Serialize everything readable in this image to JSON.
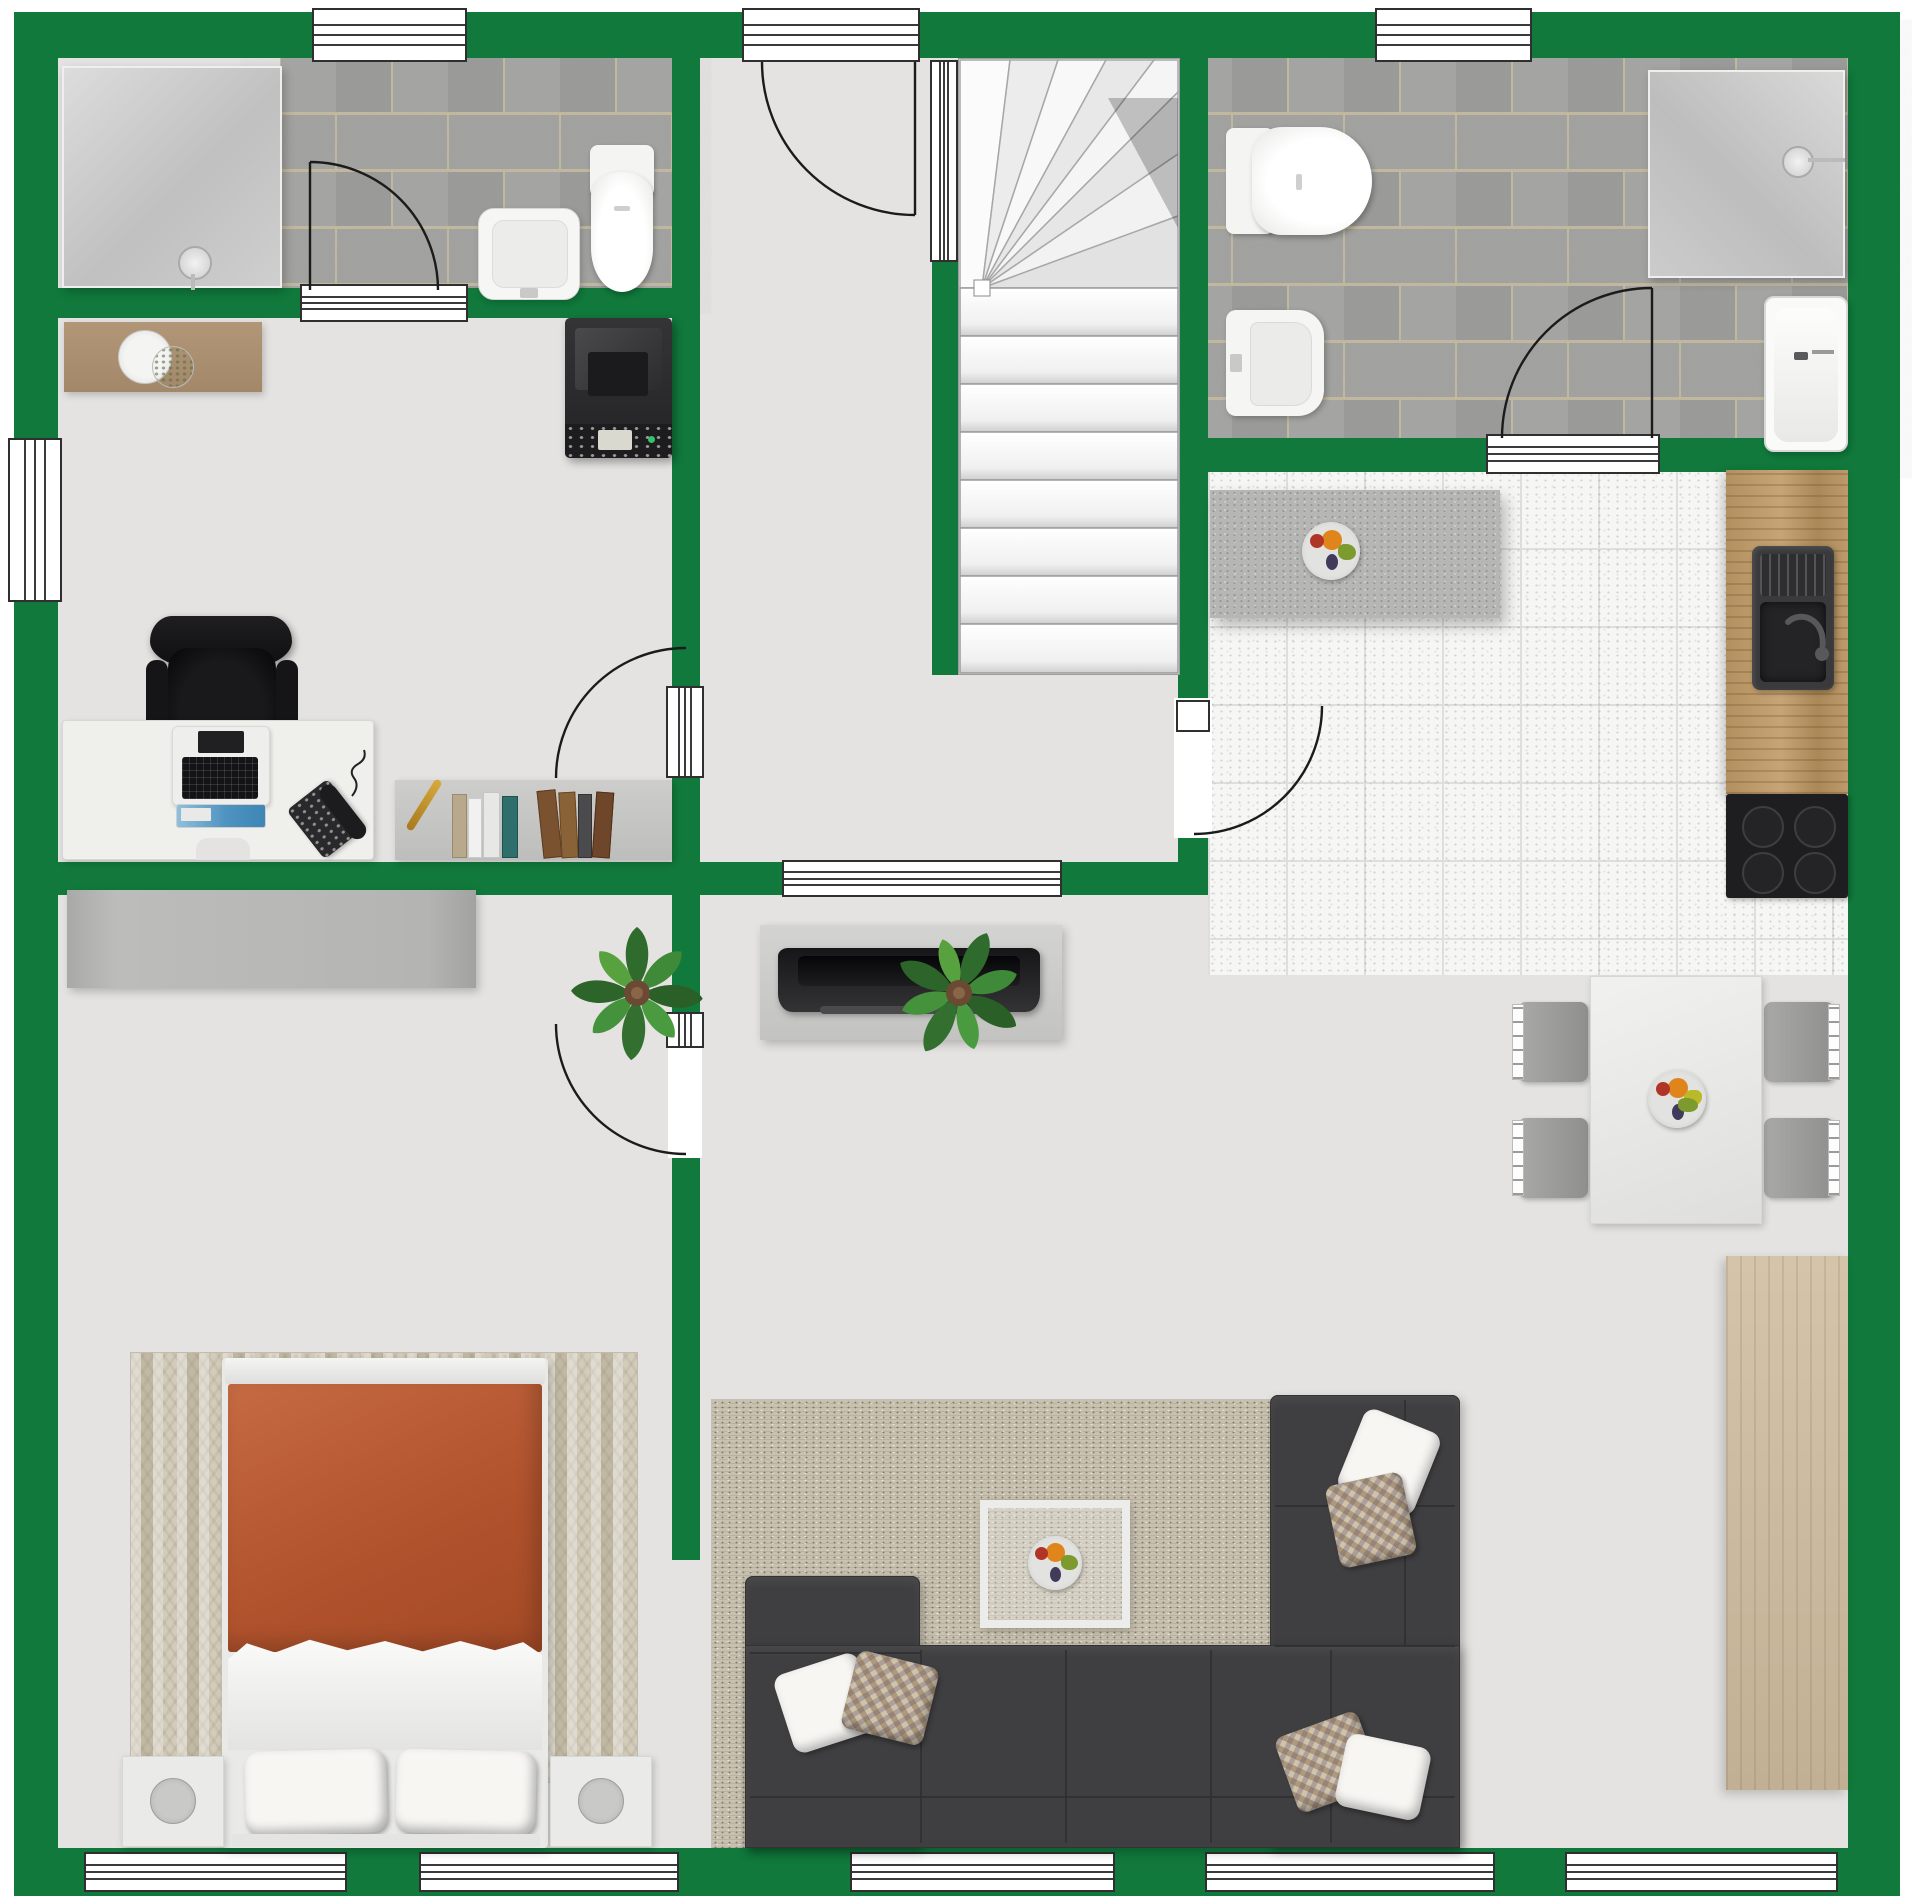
{
  "app": {
    "type": "floor-plan-render",
    "canvas": {
      "width": 1920,
      "height": 1903
    }
  },
  "palette": {
    "wall_green": "#10793b",
    "floor_gray": "#e4e3e1",
    "bath_tile_gray": "#9d9d9b",
    "tile_grout": "#c2b89c",
    "kitchen_tile_white": "#f6f6f4",
    "island_gray": "#b6b6b4",
    "sofa_charcoal": "#3f3f41",
    "duvet_terracotta": "#b85c38",
    "wood_counter": "#b39060",
    "wood_sideboard": "#cbbb9f",
    "rug_living_beige": "#c8c1b0",
    "rug_bedroom_beige": "#d3ccbb",
    "door_arc_black": "#1b1b1b"
  },
  "rooms": [
    {
      "id": "bathroom-top-left",
      "fixtures": [
        "walk-in-shower",
        "shower-head",
        "washbasin",
        "toilet",
        "gray-brick-tile-floor",
        "entry-door-arc",
        "top-window"
      ]
    },
    {
      "id": "hallway",
      "fixtures": [
        "entry-door",
        "door-sidelight",
        "winder-staircase"
      ]
    },
    {
      "id": "bathroom-top-right",
      "fixtures": [
        "toilet",
        "bidet",
        "walk-in-shower",
        "bathtub",
        "gray-brick-tile-floor",
        "door-arc",
        "top-window"
      ]
    },
    {
      "id": "kitchen",
      "fixtures": [
        "island-counter",
        "fruit-bowl",
        "wood-counter",
        "double-sink",
        "faucet",
        "induction-cooktop",
        "white-speckled-tiles",
        "door-arc"
      ]
    },
    {
      "id": "office",
      "fixtures": [
        "console-sideboard",
        "decor-plate",
        "multifunction-printer",
        "office-chair",
        "desk",
        "laptop",
        "tablet-screen",
        "desk-phone",
        "bookshelf",
        "books",
        "gold-pen",
        "left-window"
      ]
    },
    {
      "id": "bedroom",
      "fixtures": [
        "wardrobe",
        "patterned-rug",
        "double-bed",
        "headboard",
        "terracotta-duvet",
        "sheet-fold",
        "two-pillows",
        "nightstand-left",
        "nightstand-right",
        "round-lamps",
        "door-arc",
        "monstera-plant"
      ]
    },
    {
      "id": "living-room",
      "fixtures": [
        "tv-sideboard",
        "flatscreen-tv",
        "interior-window",
        "monstera-plant",
        "dining-table",
        "four-chairs",
        "fruit-bowl",
        "wood-sideboard",
        "textured-rug",
        "u-shaped-sectional-sofa",
        "sofa-cushions",
        "glass-coffee-table",
        "fruit-plate",
        "bottom-windows"
      ]
    }
  ],
  "counts": {
    "windows_exterior": 9,
    "windows_interior": 2,
    "door_arcs": 6,
    "straight_stair_treads": 8,
    "winder_treads": 7,
    "dining_chairs": 4,
    "sofa_pillows": 6,
    "plants": 2
  }
}
